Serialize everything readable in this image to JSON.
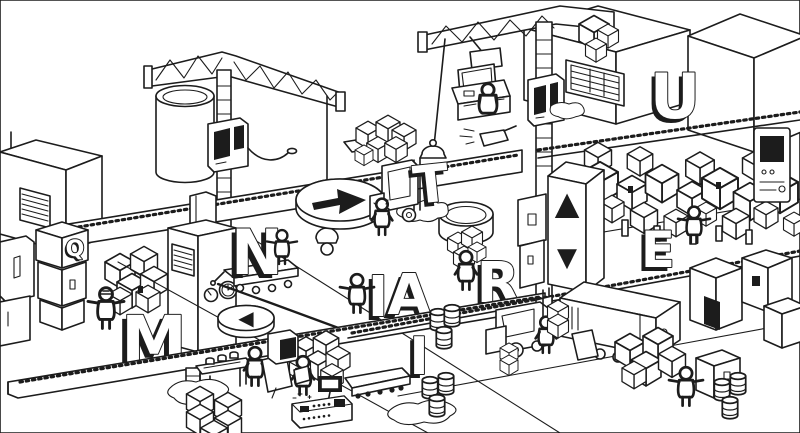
{
  "palette": {
    "ink": "#1c1c1c",
    "paper": "#ffffff"
  },
  "letters": [
    {
      "id": "letter-m",
      "char": "M"
    },
    {
      "id": "letter-i1",
      "char": "I"
    },
    {
      "id": "letter-n",
      "char": "N"
    },
    {
      "id": "letter-i2",
      "char": "I"
    },
    {
      "id": "letter-a",
      "char": "A"
    },
    {
      "id": "letter-t",
      "char": "T"
    },
    {
      "id": "letter-u",
      "char": "U"
    },
    {
      "id": "letter-r",
      "char": "R"
    },
    {
      "id": "letter-e",
      "char": "E"
    },
    {
      "id": "letter-q",
      "char": "Q"
    }
  ],
  "markers": {
    "elevator_up": "▲",
    "elevator_down": "▼",
    "turn_left": "◀"
  }
}
